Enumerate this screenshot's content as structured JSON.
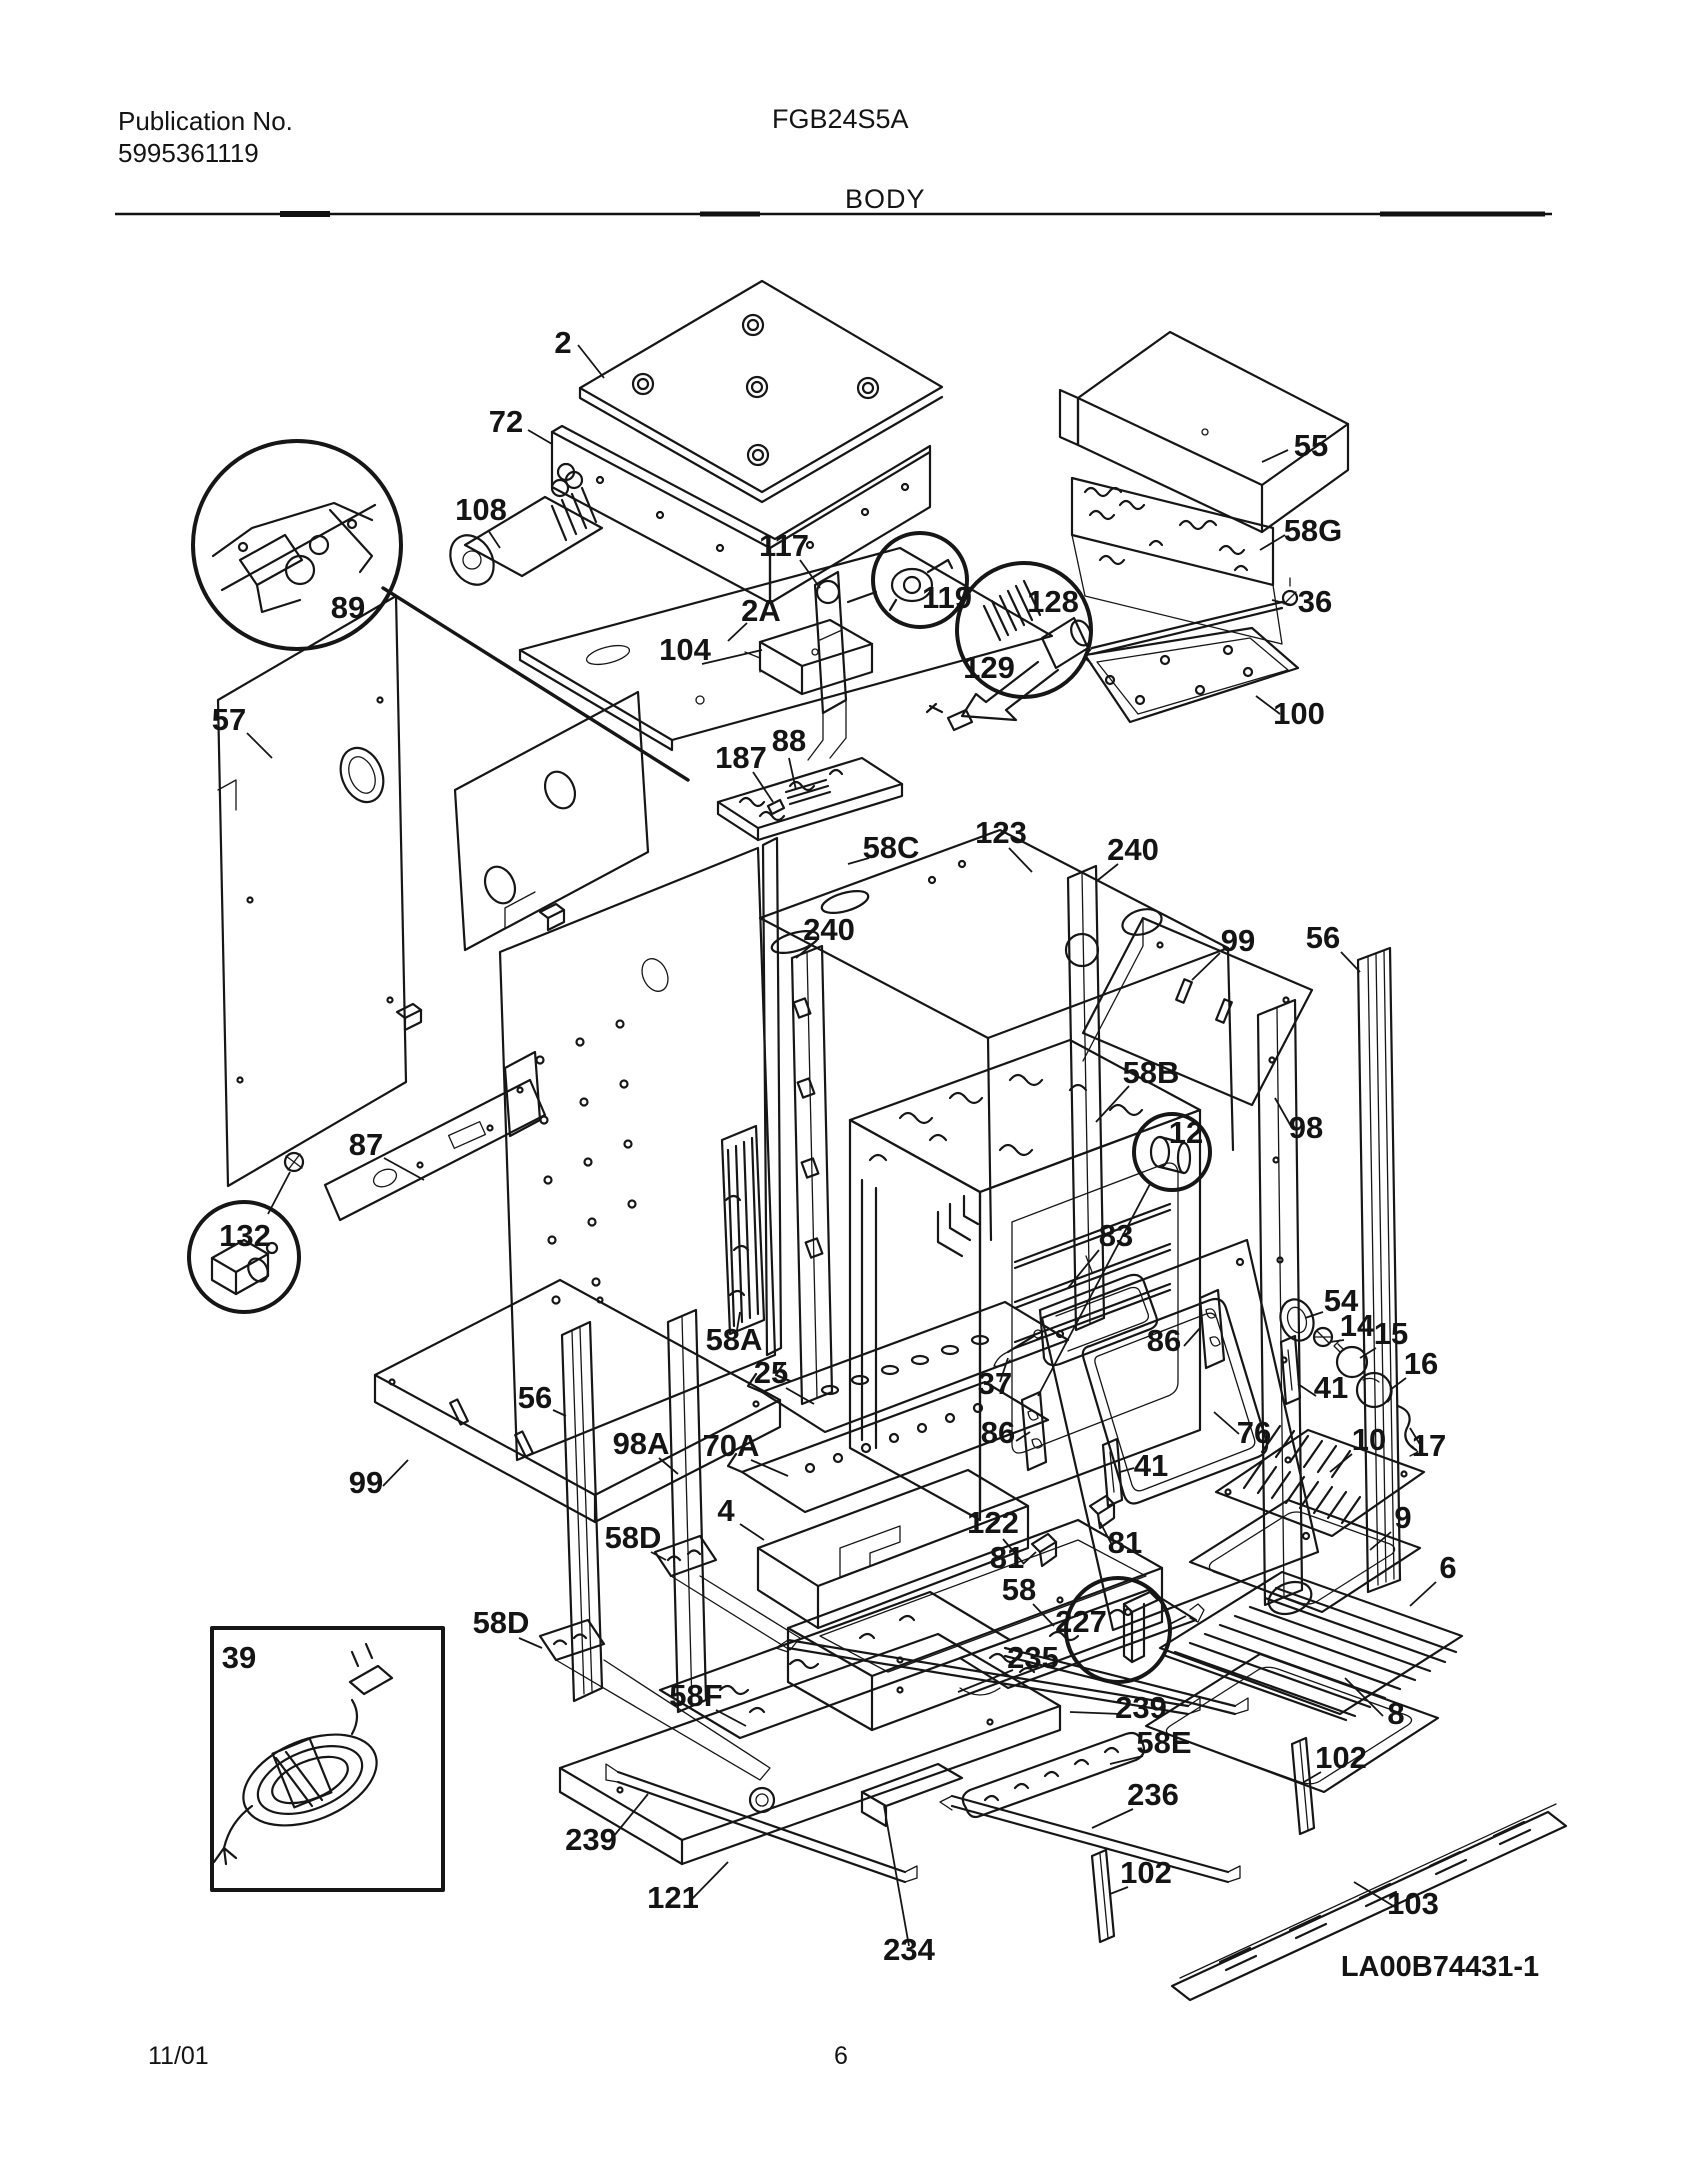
{
  "header": {
    "publication_label": "Publication No.",
    "publication_number": "5995361119",
    "model": "FGB24S5A",
    "section_title": "BODY"
  },
  "footer": {
    "date": "11/01",
    "page_number": "6"
  },
  "diagram": {
    "drawing_number": "LA00B74431-1",
    "description": "Exploded parts view of oven body assembly",
    "callouts": [
      {
        "id": "2",
        "x": 563,
        "y": 353,
        "leader": [
          578,
          345,
          604,
          378
        ]
      },
      {
        "id": "72",
        "x": 506,
        "y": 432,
        "leader": [
          528,
          430,
          552,
          444
        ]
      },
      {
        "id": "108",
        "x": 481,
        "y": 520,
        "leader": [
          488,
          530,
          500,
          548
        ]
      },
      {
        "id": "89",
        "x": 348,
        "y": 618
      },
      {
        "id": "117",
        "x": 784,
        "y": 556,
        "leader": [
          800,
          560,
          820,
          588
        ]
      },
      {
        "id": "119",
        "x": 947,
        "y": 608
      },
      {
        "id": "128",
        "x": 1053,
        "y": 612
      },
      {
        "id": "129",
        "x": 989,
        "y": 678
      },
      {
        "id": "55",
        "x": 1311,
        "y": 456,
        "leader": [
          1288,
          450,
          1262,
          462
        ]
      },
      {
        "id": "58G",
        "x": 1313,
        "y": 541,
        "leader": [
          1285,
          535,
          1260,
          550
        ]
      },
      {
        "id": "36",
        "x": 1315,
        "y": 612,
        "leader": [
          1292,
          605,
          1272,
          600
        ]
      },
      {
        "id": "100",
        "x": 1299,
        "y": 724,
        "leader": [
          1280,
          714,
          1256,
          696
        ]
      },
      {
        "id": "57",
        "x": 229,
        "y": 730,
        "leader": [
          247,
          733,
          272,
          758
        ]
      },
      {
        "id": "2A",
        "x": 761,
        "y": 621,
        "leader": [
          747,
          623,
          728,
          641
        ]
      },
      {
        "id": "104",
        "x": 685,
        "y": 660,
        "leader": [
          702,
          664,
          762,
          650
        ]
      },
      {
        "id": "88",
        "x": 789,
        "y": 751,
        "leader": [
          789,
          758,
          796,
          790
        ]
      },
      {
        "id": "187",
        "x": 741,
        "y": 768,
        "leader": [
          753,
          772,
          773,
          802
        ]
      },
      {
        "id": "58C",
        "x": 891,
        "y": 858,
        "leader": [
          869,
          858,
          848,
          864
        ]
      },
      {
        "id": "123",
        "x": 1001,
        "y": 843,
        "leader": [
          1009,
          848,
          1032,
          872
        ]
      },
      {
        "id": "240",
        "x": 1133,
        "y": 860,
        "leader": [
          1118,
          864,
          1098,
          880
        ]
      },
      {
        "id": "240",
        "x": 829,
        "y": 940,
        "leader": [
          813,
          944,
          796,
          958
        ]
      },
      {
        "id": "99",
        "x": 1238,
        "y": 951,
        "leader": [
          1220,
          953,
          1192,
          980
        ]
      },
      {
        "id": "56",
        "x": 1323,
        "y": 948,
        "leader": [
          1341,
          952,
          1360,
          972
        ]
      },
      {
        "id": "58B",
        "x": 1151,
        "y": 1083,
        "leader": [
          1129,
          1086,
          1096,
          1122
        ]
      },
      {
        "id": "12",
        "x": 1186,
        "y": 1143,
        "leader": [
          1150,
          1184,
          1038,
          1396
        ]
      },
      {
        "id": "98",
        "x": 1306,
        "y": 1138,
        "leader": [
          1292,
          1128,
          1275,
          1098
        ]
      },
      {
        "id": "87",
        "x": 366,
        "y": 1155,
        "leader": [
          384,
          1158,
          424,
          1180
        ]
      },
      {
        "id": "132",
        "x": 245,
        "y": 1246,
        "leader": [
          268,
          1214,
          290,
          1172
        ]
      },
      {
        "id": "83",
        "x": 1116,
        "y": 1246,
        "leader": [
          1099,
          1250,
          1068,
          1288
        ]
      },
      {
        "id": "86",
        "x": 1164,
        "y": 1351,
        "leader": [
          1184,
          1346,
          1200,
          1328
        ]
      },
      {
        "id": "54",
        "x": 1341,
        "y": 1311,
        "leader": [
          1323,
          1312,
          1305,
          1318
        ]
      },
      {
        "id": "14",
        "x": 1357,
        "y": 1336,
        "leader": [
          1344,
          1340,
          1330,
          1342
        ]
      },
      {
        "id": "15",
        "x": 1391,
        "y": 1344,
        "leader": [
          1376,
          1348,
          1360,
          1358
        ]
      },
      {
        "id": "16",
        "x": 1421,
        "y": 1374,
        "leader": [
          1406,
          1378,
          1390,
          1390
        ]
      },
      {
        "id": "41",
        "x": 1331,
        "y": 1398,
        "leader": [
          1316,
          1396,
          1298,
          1384
        ]
      },
      {
        "id": "17",
        "x": 1429,
        "y": 1456,
        "leader": [
          1421,
          1446,
          1410,
          1428
        ]
      },
      {
        "id": "76",
        "x": 1254,
        "y": 1443,
        "leader": [
          1239,
          1434,
          1214,
          1412
        ]
      },
      {
        "id": "10",
        "x": 1369,
        "y": 1450,
        "leader": [
          1352,
          1454,
          1330,
          1472
        ]
      },
      {
        "id": "86",
        "x": 998,
        "y": 1443,
        "leader": [
          1016,
          1441,
          1030,
          1432
        ]
      },
      {
        "id": "37",
        "x": 995,
        "y": 1394,
        "leader": [
          1000,
          1382,
          1008,
          1358
        ]
      },
      {
        "id": "41",
        "x": 1151,
        "y": 1476,
        "leader": [
          1134,
          1468,
          1120,
          1472
        ]
      },
      {
        "id": "9",
        "x": 1403,
        "y": 1528,
        "leader": [
          1391,
          1532,
          1370,
          1550
        ]
      },
      {
        "id": "25",
        "x": 771,
        "y": 1383,
        "leader": [
          786,
          1388,
          814,
          1404
        ]
      },
      {
        "id": "58A",
        "x": 734,
        "y": 1350,
        "leader": [
          736,
          1336,
          740,
          1312
        ]
      },
      {
        "id": "70A",
        "x": 731,
        "y": 1456,
        "leader": [
          751,
          1460,
          788,
          1476
        ]
      },
      {
        "id": "56",
        "x": 535,
        "y": 1408,
        "leader": [
          553,
          1410,
          566,
          1416
        ]
      },
      {
        "id": "98A",
        "x": 641,
        "y": 1454,
        "leader": [
          659,
          1458,
          678,
          1474
        ]
      },
      {
        "id": "99",
        "x": 366,
        "y": 1493,
        "leader": [
          383,
          1486,
          408,
          1460
        ]
      },
      {
        "id": "6",
        "x": 1448,
        "y": 1578,
        "leader": [
          1436,
          1582,
          1410,
          1606
        ]
      },
      {
        "id": "4",
        "x": 726,
        "y": 1521,
        "leader": [
          740,
          1524,
          764,
          1540
        ]
      },
      {
        "id": "122",
        "x": 993,
        "y": 1533,
        "leader": [
          1003,
          1539,
          1024,
          1564
        ]
      },
      {
        "id": "81",
        "x": 1007,
        "y": 1568,
        "leader": [
          1023,
          1564,
          1036,
          1552
        ]
      },
      {
        "id": "81",
        "x": 1125,
        "y": 1553,
        "leader": [
          1112,
          1545,
          1100,
          1522
        ]
      },
      {
        "id": "58D",
        "x": 633,
        "y": 1548,
        "leader": [
          651,
          1552,
          666,
          1560
        ]
      },
      {
        "id": "58",
        "x": 1019,
        "y": 1600,
        "leader": [
          1033,
          1604,
          1054,
          1626
        ]
      },
      {
        "id": "227",
        "x": 1081,
        "y": 1632,
        "leader": [
          1170,
          1624,
          1186,
          1616
        ]
      },
      {
        "id": "235",
        "x": 1033,
        "y": 1668,
        "leader": [
          1013,
          1670,
          958,
          1692
        ]
      },
      {
        "id": "58D",
        "x": 501,
        "y": 1633,
        "leader": [
          519,
          1638,
          542,
          1648
        ]
      },
      {
        "id": "8",
        "x": 1396,
        "y": 1724,
        "leader": [
          1383,
          1716,
          1345,
          1678
        ]
      },
      {
        "id": "39",
        "x": 239,
        "y": 1668
      },
      {
        "id": "58F",
        "x": 696,
        "y": 1706,
        "leader": [
          716,
          1710,
          746,
          1726
        ]
      },
      {
        "id": "239",
        "x": 1141,
        "y": 1718,
        "leader": [
          1121,
          1714,
          1070,
          1712
        ]
      },
      {
        "id": "58E",
        "x": 1164,
        "y": 1753,
        "leader": [
          1143,
          1756,
          1110,
          1764
        ]
      },
      {
        "id": "102",
        "x": 1341,
        "y": 1768,
        "leader": [
          1321,
          1772,
          1304,
          1782
        ]
      },
      {
        "id": "236",
        "x": 1153,
        "y": 1805,
        "leader": [
          1133,
          1809,
          1092,
          1828
        ]
      },
      {
        "id": "239",
        "x": 591,
        "y": 1850,
        "leader": [
          609,
          1842,
          648,
          1794
        ]
      },
      {
        "id": "102",
        "x": 1146,
        "y": 1883,
        "leader": [
          1128,
          1887,
          1110,
          1894
        ]
      },
      {
        "id": "121",
        "x": 673,
        "y": 1908,
        "leader": [
          691,
          1900,
          728,
          1862
        ]
      },
      {
        "id": "103",
        "x": 1413,
        "y": 1914,
        "leader": [
          1395,
          1907,
          1354,
          1882
        ]
      },
      {
        "id": "234",
        "x": 909,
        "y": 1960,
        "leader": [
          909,
          1946,
          884,
          1806
        ]
      }
    ]
  }
}
